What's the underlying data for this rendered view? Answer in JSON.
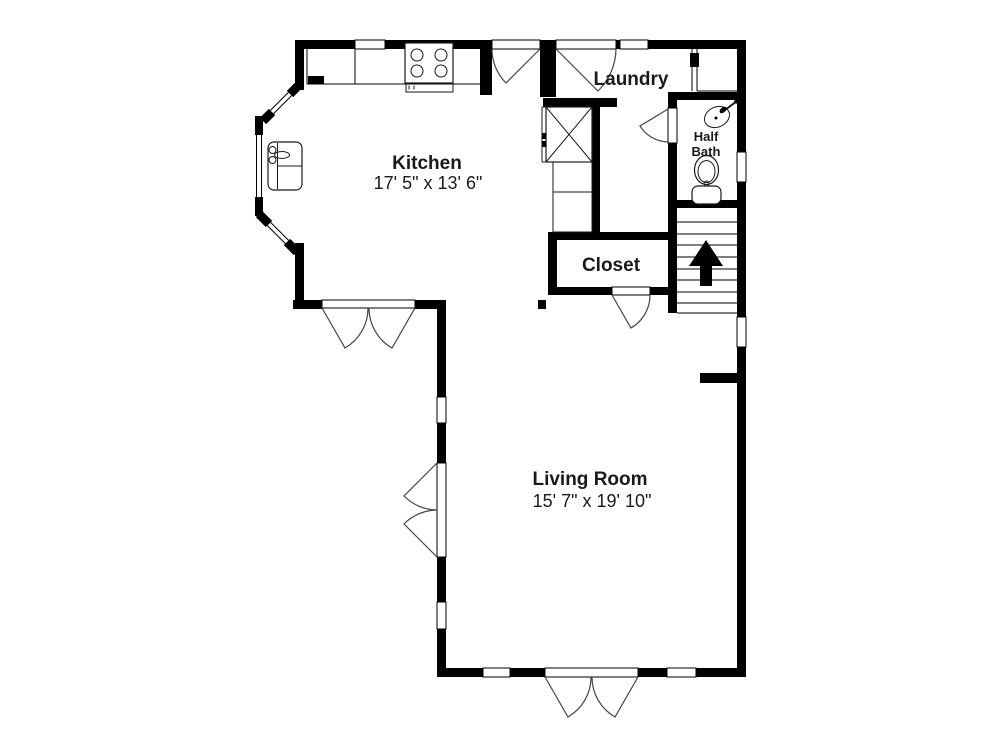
{
  "colors": {
    "background": "#ffffff",
    "wall": "#000000",
    "door_arc": "#444444",
    "text": "#1a1a1a"
  },
  "rooms": {
    "kitchen": {
      "label": "Kitchen",
      "dimensions": "17' 5\" x 13' 6\""
    },
    "laundry": {
      "label": "Laundry"
    },
    "half_bath": {
      "label_line1": "Half",
      "label_line2": "Bath"
    },
    "closet": {
      "label": "Closet"
    },
    "living_room": {
      "label": "Living Room",
      "dimensions": "15' 7\" x 19' 10\""
    }
  },
  "fixtures": {
    "kitchen": [
      "stove",
      "kitchen-sink",
      "counter",
      "cabinets"
    ],
    "laundry": [
      "washer-dryer"
    ],
    "half_bath": [
      "bathroom-sink",
      "toilet"
    ],
    "stairs": [
      "up-arrow"
    ]
  }
}
